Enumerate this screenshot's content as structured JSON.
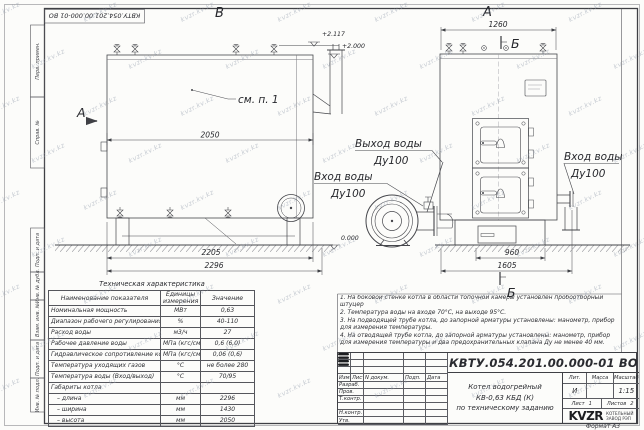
{
  "doc": {
    "number": "КВТУ.054.201.00.000-01 ВО",
    "format_label": "Формат А3"
  },
  "margin": {
    "fields": [
      "Перв. примен.",
      "Справ. №",
      "Подп. и дата",
      "Инв. № дубл.",
      "Взам. инв. №",
      "Подп. и дата",
      "Инв. № подл."
    ]
  },
  "views": {
    "b": "В",
    "a": "А",
    "section_a": "А",
    "section_b_top": "Б",
    "section_b_bottom": "Б",
    "see_note": "см. п. 1",
    "water_out_1": "Выход воды",
    "water_out_2": "Ду100",
    "water_in_left_1": "Вход воды",
    "water_in_left_2": "Ду100",
    "water_in_right_1": "Вход воды",
    "water_in_right_2": "Ду100"
  },
  "dims": {
    "len_top": "2050",
    "len_mid": "2205",
    "len_full": "2296",
    "width_top": "1260",
    "w1": "960",
    "w2": "1605",
    "lvl1": "+2.117",
    "lvl2": "+2.000",
    "lvl0": "0.000"
  },
  "tech_table": {
    "title": "Техническая характеристика",
    "headers": [
      "Наименование показателя",
      "Единицы измерения",
      "Значение"
    ],
    "rows": [
      {
        "name": "Номинальная мощность",
        "unit": "МВт",
        "value": "0,63"
      },
      {
        "name": "Диапазон рабочего регулирования",
        "unit": "%",
        "value": "40-110"
      },
      {
        "name": "Расход воды",
        "unit": "м3/ч",
        "value": "27"
      },
      {
        "name": "Рабочее давление воды",
        "unit": "МПа (кгс/см2)",
        "value": "0,6 (6,0)"
      },
      {
        "name": "Гидравлическое сопротивление котла",
        "unit": "МПа (кгс/см2)",
        "value": "0,06 (0,6)"
      },
      {
        "name": "Температура уходящих газов",
        "unit": "°С",
        "value": "не более 280"
      },
      {
        "name": "Температура воды (Вход/выход)",
        "unit": "°С",
        "value": "70/95"
      },
      {
        "name": "Габариты котла",
        "unit": "",
        "value": ""
      },
      {
        "name": "– длина",
        "unit": "мм",
        "value": "2296"
      },
      {
        "name": "– ширина",
        "unit": "мм",
        "value": "1430"
      },
      {
        "name": "– высота",
        "unit": "мм",
        "value": "2050"
      }
    ]
  },
  "notes": {
    "items": [
      "1.  На боковой стенке котла в области топочной камеры установлен пробоотборный штуцер",
      "2.  Температура воды на входе 70°С, на выходе 95°С.",
      "3.  На подводящей трубе котла, до запорной арматуры установлены: манометр, прибор для измерения температуры.",
      "4.  На отводящей трубе котла, до запорной арматуры установлены: манометр, прибор для измерения температуры и два предохранительных клапана Ду не менее 40 мм.",
      "5.  Остальные технические требования по ОСТ 108.030.133-84."
    ]
  },
  "title_block": {
    "header_cols": [
      "Изм.",
      "Лист",
      "N докум.",
      "Подп.",
      "Дата"
    ],
    "rows": [
      "Разраб.",
      "Пров.",
      "Т.контр.",
      "",
      "Н.контр.",
      "Утв."
    ],
    "title_lines": [
      "Котел водогрейный",
      "КВ-0,63 КБД (К)",
      "по техническому заданию"
    ],
    "lit_label": "Лит.",
    "lit_value": "И",
    "mass_label": "Масса",
    "mass_value": "",
    "scale_label": "Масштаб",
    "scale_value": "1:15",
    "sheet_label": "Лист",
    "sheet_value": "1",
    "sheets_label": "Листов",
    "sheets_value": "2",
    "logo_text": "KVZR",
    "logo_sub1": "КОТЕЛЬНЫЙ",
    "logo_sub2": "ЗАВОД РЭП"
  },
  "watermark": "kvzr.kv.kz"
}
